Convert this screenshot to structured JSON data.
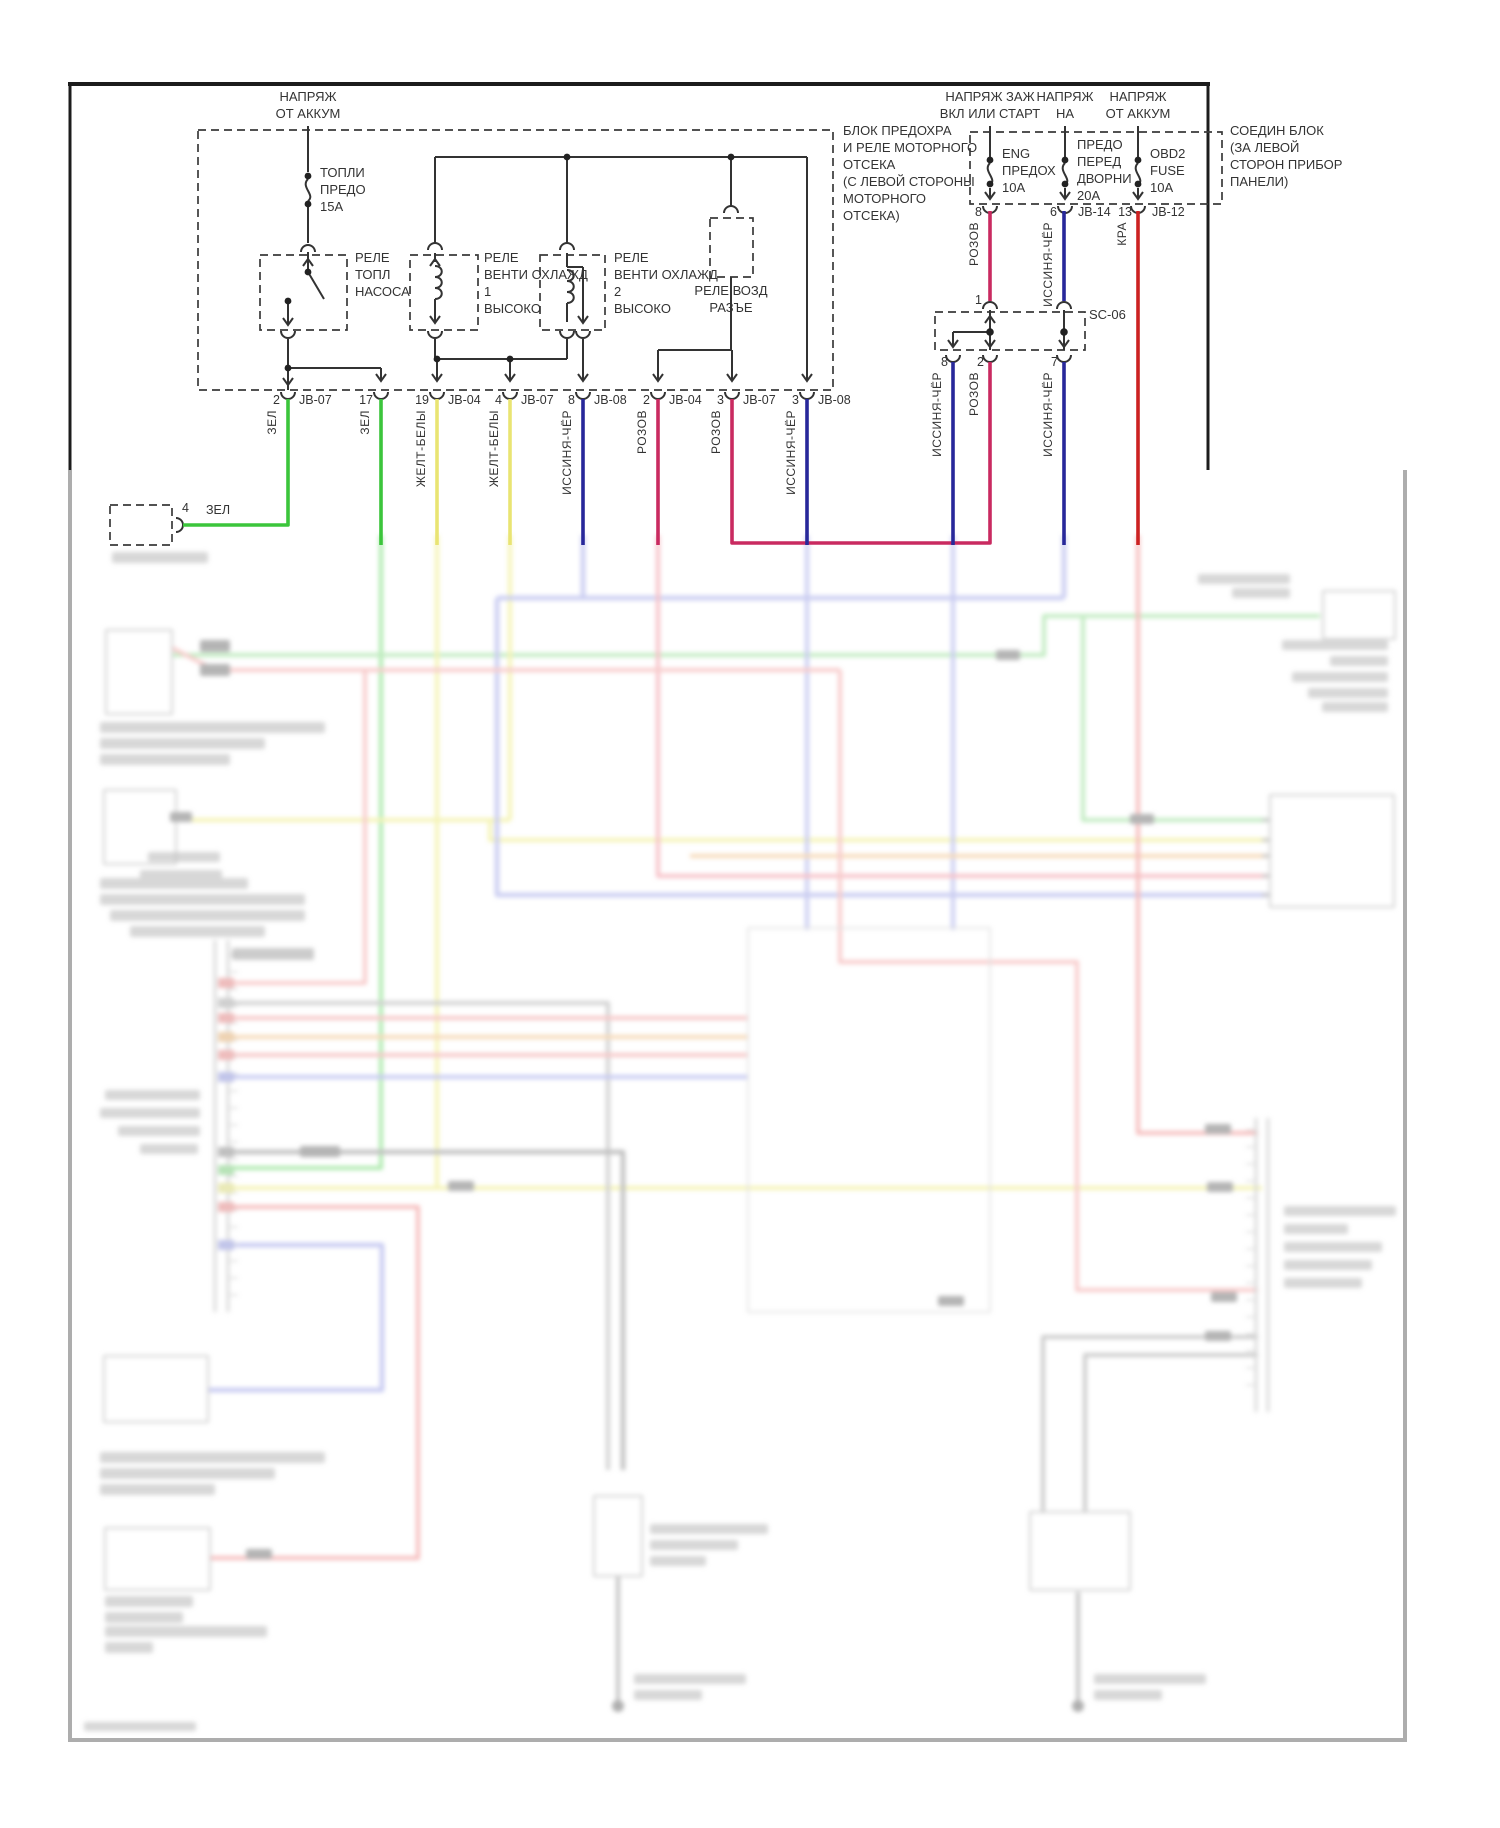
{
  "diagram": {
    "power_sources": {
      "batt_left": [
        "НАПРЯЖ",
        "ОТ АККУМ"
      ],
      "ign_start": [
        "НАПРЯЖ ЗАЖ",
        "ВКЛ ИЛИ СТАРТ"
      ],
      "acc": [
        "НАПРЯЖ",
        "НА"
      ],
      "batt_right": [
        "НАПРЯЖ",
        "ОТ АККУМ"
      ]
    },
    "fuses": {
      "fuel": [
        "ТОПЛИ",
        "ПРЕДО",
        "15А"
      ],
      "eng": [
        "ENG",
        "ПРЕДОХ",
        "10А"
      ],
      "wiper": [
        "ПРЕДО",
        "ПЕРЕД",
        "ДВОРНИ",
        "20А"
      ],
      "obd2": [
        "OBD2",
        "FUSE",
        "10А"
      ]
    },
    "relays": {
      "fuel_pump": [
        "РЕЛЕ",
        "ТОПЛ",
        "НАСОСА"
      ],
      "fan1": [
        "РЕЛЕ",
        "ВЕНТИ ОХЛАЖД",
        "1",
        "ВЫСОКО"
      ],
      "fan2": [
        "РЕЛЕ",
        "ВЕНТИ ОХЛАЖД",
        "2",
        "ВЫСОКО"
      ],
      "air": [
        "РЕЛЕ ВОЗД",
        "РАЗЪЕ"
      ]
    },
    "blocks": {
      "engine": [
        "БЛОК ПРЕДОХРА",
        "И РЕЛЕ МОТОРНОГО",
        "ОТСЕКА",
        "(С ЛЕВОЙ СТОРОНЫ",
        "МОТОРНОГО",
        "ОТСЕКА)"
      ],
      "join": [
        "СОЕДИН БЛОК",
        "(ЗА ЛЕВОЙ",
        "СТОРОН ПРИБОР",
        "ПАНЕЛИ)"
      ],
      "splice": "SC-06"
    },
    "pins_bottom": [
      {
        "num": "2",
        "jb": "JB-07",
        "wire": "ЗЕЛ"
      },
      {
        "num": "17",
        "jb": "",
        "wire": "ЗЕЛ"
      },
      {
        "num": "19",
        "jb": "JB-04",
        "wire": "ЖЕЛТ-БЕЛЫ"
      },
      {
        "num": "4",
        "jb": "JB-07",
        "wire": "ЖЕЛТ-БЕЛЫ"
      },
      {
        "num": "8",
        "jb": "JB-08",
        "wire": "ИССИНЯ-ЧЁР"
      },
      {
        "num": "2",
        "jb": "JB-04",
        "wire": "РОЗОВ"
      },
      {
        "num": "3",
        "jb": "JB-07",
        "wire": "РОЗОВ"
      },
      {
        "num": "3",
        "jb": "JB-08",
        "wire": "ИССИНЯ-ЧЁР"
      }
    ],
    "pins_right": [
      {
        "num": "8",
        "jb": "",
        "wire": "РОЗОВ"
      },
      {
        "num": "6",
        "jb": "JB-14",
        "wire": "ИССИНЯ-ЧЁР"
      },
      {
        "num": "13",
        "jb": "JB-12",
        "wire": "КРА"
      }
    ],
    "splice_pins": {
      "in": "1",
      "out1": "8",
      "out2": "2",
      "out3": "7",
      "w1": "ИССИНЯ-ЧЁР",
      "w2": "РОЗОВ",
      "w3": "ИССИНЯ-ЧЁР"
    },
    "left_connector": {
      "num": "4",
      "wire": "ЗЕЛ"
    },
    "wire_colors": {
      "green": "#3bc53b",
      "yellow": "#e9e473",
      "blue": "#28289a",
      "pink": "#c92a60",
      "red": "#cc2222"
    }
  }
}
